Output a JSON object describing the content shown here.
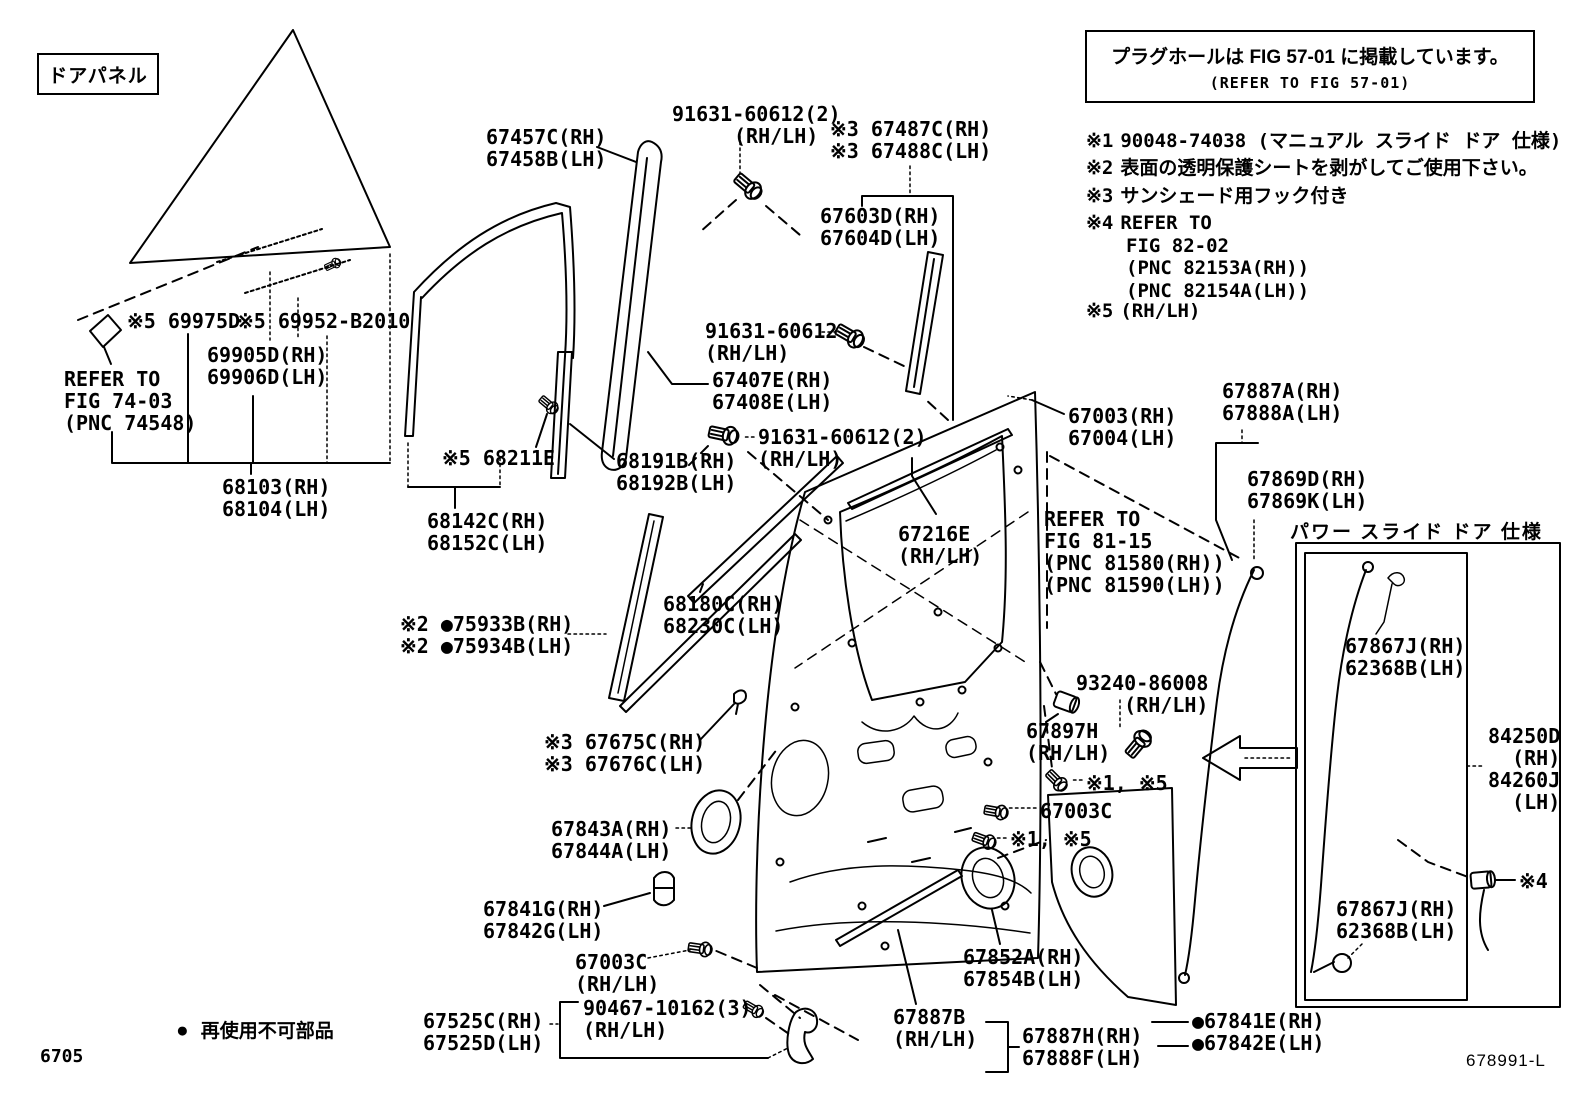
{
  "page": {
    "page_number": "6705",
    "diagram_id": "678991-L"
  },
  "door_panel_tag": "ドアパネル",
  "plug_hole_note": {
    "line1": "プラグホールは FIG 57-01 に掲載しています。",
    "line2": "(REFER TO FIG 57-01)"
  },
  "notes": [
    {
      "marker": "※1",
      "lines": [
        "90048-74038 (マニュアル スライド ドア 仕様)"
      ]
    },
    {
      "marker": "※2",
      "lines": [
        "表面の透明保護シートを剥がしてご使用下さい。"
      ]
    },
    {
      "marker": "※3",
      "lines": [
        "サンシェード用フック付き"
      ]
    },
    {
      "marker": "※4",
      "lines": [
        "REFER TO",
        "FIG 82-02",
        "(PNC 82153A(RH))",
        "(PNC 82154A(LH))"
      ]
    },
    {
      "marker": "※5",
      "lines": [
        "(RH/LH)"
      ]
    }
  ],
  "legend": {
    "symbol": "●",
    "text": "再使用不可部品"
  },
  "power_slide_box_title": "パワー スライド ドア 仕様",
  "labels": [
    {
      "id": "label-69975d",
      "x": 127,
      "y": 310,
      "lines": [
        "※5 69975D"
      ]
    },
    {
      "id": "label-69952",
      "x": 237,
      "y": 310,
      "lines": [
        "※5 69952-B2010"
      ]
    },
    {
      "id": "label-69905d",
      "x": 207,
      "y": 344,
      "lines": [
        "69905D(RH)",
        "69906D(LH)"
      ]
    },
    {
      "id": "label-refer-fig-74-03",
      "x": 64,
      "y": 368,
      "lines": [
        "REFER TO",
        "FIG 74-03",
        "(PNC 74548)"
      ]
    },
    {
      "id": "label-68103",
      "x": 222,
      "y": 476,
      "lines": [
        "68103(RH)",
        "68104(LH)"
      ]
    },
    {
      "id": "label-67457c",
      "x": 486,
      "y": 126,
      "lines": [
        "67457C(RH)",
        "67458B(LH)"
      ]
    },
    {
      "id": "label-91631-top",
      "x": 672,
      "y": 103,
      "lines": [
        "91631-60612(2)",
        "(RH/LH)"
      ],
      "indent2": 62
    },
    {
      "id": "label-67487c",
      "x": 830,
      "y": 118,
      "lines": [
        "※3 67487C(RH)",
        "※3 67488C(LH)"
      ]
    },
    {
      "id": "label-67603d",
      "x": 820,
      "y": 205,
      "lines": [
        "67603D(RH)",
        "67604D(LH)"
      ]
    },
    {
      "id": "label-91631-mid",
      "x": 705,
      "y": 320,
      "lines": [
        "91631-60612",
        "(RH/LH)"
      ]
    },
    {
      "id": "label-67407e",
      "x": 712,
      "y": 369,
      "lines": [
        "67407E(RH)",
        "67408E(LH)"
      ]
    },
    {
      "id": "label-91631-low",
      "x": 758,
      "y": 426,
      "lines": [
        "91631-60612(2)",
        "(RH/LH)"
      ]
    },
    {
      "id": "label-68191b",
      "x": 616,
      "y": 450,
      "lines": [
        "68191B(RH)",
        "68192B(LH)"
      ]
    },
    {
      "id": "label-68211e",
      "x": 442,
      "y": 447,
      "lines": [
        "※5 68211E"
      ]
    },
    {
      "id": "label-68142c",
      "x": 427,
      "y": 510,
      "lines": [
        "68142C(RH)",
        "68152C(LH)"
      ]
    },
    {
      "id": "label-75933b",
      "x": 400,
      "y": 613,
      "lines": [
        "※2 ●75933B(RH)",
        "※2 ●75934B(LH)"
      ]
    },
    {
      "id": "label-68180c",
      "x": 663,
      "y": 593,
      "lines": [
        "68180C(RH)",
        "68230C(LH)"
      ]
    },
    {
      "id": "label-67675c",
      "x": 544,
      "y": 731,
      "lines": [
        "※3 67675C(RH)",
        "※3 67676C(LH)"
      ]
    },
    {
      "id": "label-67843a",
      "x": 551,
      "y": 818,
      "lines": [
        "67843A(RH)",
        "67844A(LH)"
      ]
    },
    {
      "id": "label-67841g",
      "x": 483,
      "y": 898,
      "lines": [
        "67841G(RH)",
        "67842G(LH)"
      ]
    },
    {
      "id": "label-67003c-bottom",
      "x": 575,
      "y": 951,
      "lines": [
        "67003C",
        "(RH/LH)"
      ]
    },
    {
      "id": "label-67525c",
      "x": 423,
      "y": 1010,
      "lines": [
        "67525C(RH)",
        "67525D(LH)"
      ]
    },
    {
      "id": "label-90467",
      "x": 583,
      "y": 997,
      "lines": [
        "90467-10162(3)",
        "(RH/LH)"
      ]
    },
    {
      "id": "label-67003",
      "x": 1068,
      "y": 405,
      "lines": [
        "67003(RH)",
        "67004(LH)"
      ]
    },
    {
      "id": "label-67216e",
      "x": 898,
      "y": 523,
      "lines": [
        "67216E",
        "(RH/LH)"
      ]
    },
    {
      "id": "label-refer-fig-81-15",
      "x": 1044,
      "y": 508,
      "lines": [
        "REFER TO",
        "FIG 81-15",
        "(PNC 81580(RH))",
        "(PNC 81590(LH))"
      ]
    },
    {
      "id": "label-93240",
      "x": 1076,
      "y": 672,
      "lines": [
        "93240-86008",
        "(RH/LH)"
      ],
      "align": "right"
    },
    {
      "id": "label-67897h",
      "x": 1026,
      "y": 720,
      "lines": [
        "67897H",
        "(RH/LH)"
      ]
    },
    {
      "id": "label-note15-a",
      "x": 1086,
      "y": 772,
      "lines": [
        "※1, ※5"
      ]
    },
    {
      "id": "label-67003c-right",
      "x": 1040,
      "y": 800,
      "lines": [
        "67003C"
      ]
    },
    {
      "id": "label-note15-b",
      "x": 1010,
      "y": 828,
      "lines": [
        "※1, ※5"
      ]
    },
    {
      "id": "label-67852a",
      "x": 963,
      "y": 946,
      "lines": [
        "67852A(RH)",
        "67854B(LH)"
      ]
    },
    {
      "id": "label-67887b",
      "x": 893,
      "y": 1006,
      "lines": [
        "67887B",
        "(RH/LH)"
      ]
    },
    {
      "id": "label-67887h",
      "x": 1022,
      "y": 1025,
      "lines": [
        "67887H(RH)",
        "67888F(LH)"
      ]
    },
    {
      "id": "label-67841e",
      "x": 1192,
      "y": 1010,
      "lines": [
        "●67841E(RH)",
        "●67842E(LH)"
      ]
    },
    {
      "id": "label-67887a",
      "x": 1222,
      "y": 380,
      "lines": [
        "67887A(RH)",
        "67888A(LH)"
      ]
    },
    {
      "id": "label-67869d",
      "x": 1247,
      "y": 468,
      "lines": [
        "67869D(RH)",
        "67869K(LH)"
      ]
    },
    {
      "id": "label-67867j-top",
      "x": 1345,
      "y": 635,
      "lines": [
        "67867J(RH)",
        "62368B(LH)"
      ]
    },
    {
      "id": "label-84250d",
      "x": 1488,
      "y": 725,
      "lines": [
        "84250D",
        "(RH)",
        "84260J",
        "(LH)"
      ],
      "align": "right"
    },
    {
      "id": "label-67867j-bottom",
      "x": 1336,
      "y": 898,
      "lines": [
        "67867J(RH)",
        "62368B(LH)"
      ]
    },
    {
      "id": "label-note4-ref",
      "x": 1519,
      "y": 870,
      "lines": [
        "※4"
      ]
    }
  ]
}
